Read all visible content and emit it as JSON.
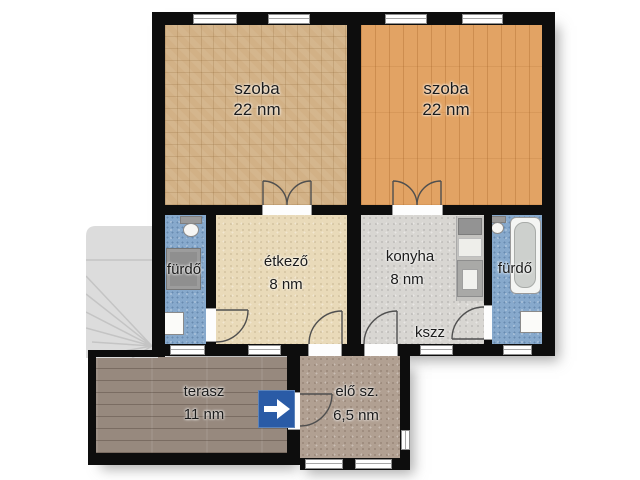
{
  "floorplan": {
    "rooms": {
      "szoba_left": {
        "name": "szoba",
        "area": "22 nm"
      },
      "szoba_right": {
        "name": "szoba",
        "area": "22 nm"
      },
      "furdo_left": {
        "name": "fürdő"
      },
      "etkezo": {
        "name": "étkező",
        "area": "8 nm"
      },
      "konyha": {
        "name": "konyha",
        "area": "8 nm"
      },
      "kszz": {
        "name": "kszz"
      },
      "furdo_right": {
        "name": "fürdő"
      },
      "terasz": {
        "name": "terasz",
        "area": "11 nm"
      },
      "eloszoba": {
        "name": "elő sz.",
        "area": "6,5 nm"
      }
    },
    "colors": {
      "wall": "#0d0d0d",
      "szoba_left_floor": "#d2b186",
      "szoba_right_floor": "#e2a364",
      "etkezo_floor": "#e9dab9",
      "konyha_floor": "#d8d6d2",
      "furdo_floor": "#87a9cc",
      "terasz_floor": "#97897e",
      "eloszoba_floor": "#b1a092",
      "entrance_sign": "#2a5ba6"
    },
    "icons": {
      "entrance": "arrow-right"
    }
  }
}
